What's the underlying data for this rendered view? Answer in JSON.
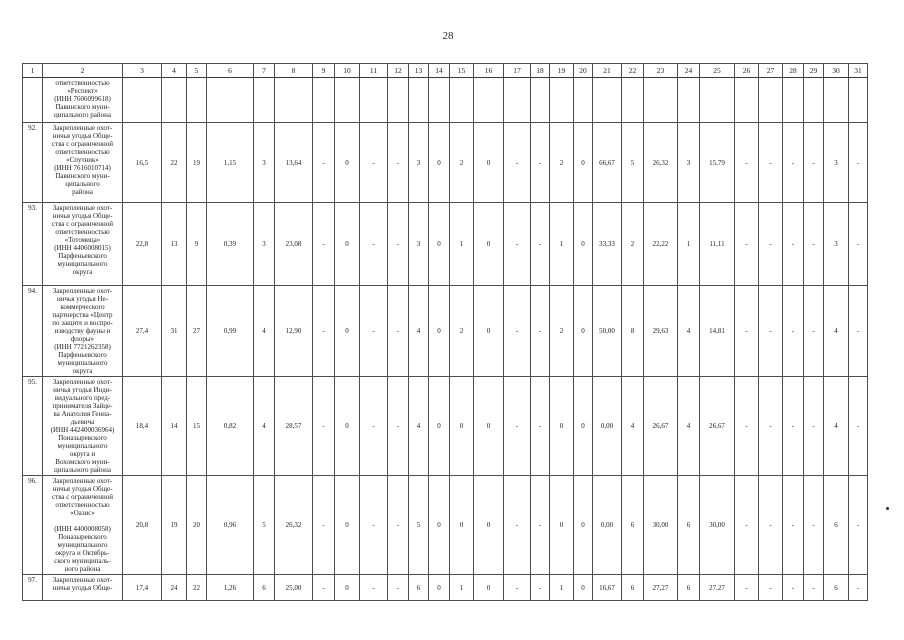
{
  "page_number": "28",
  "table": {
    "column_headers": [
      "1",
      "2",
      "3",
      "4",
      "5",
      "6",
      "7",
      "8",
      "9",
      "10",
      "11",
      "12",
      "13",
      "14",
      "15",
      "16",
      "17",
      "18",
      "19",
      "20",
      "21",
      "22",
      "23",
      "24",
      "25",
      "26",
      "27",
      "28",
      "29",
      "30",
      "31"
    ],
    "rows": [
      {
        "num": "",
        "name_lines": [
          "ответственностью",
          "«Респект»",
          "(ИНН 7606099618)",
          "Павинского муни-",
          "ципального района"
        ],
        "values": [
          "",
          "",
          "",
          "",
          "",
          "",
          "",
          "",
          "",
          "",
          "",
          "",
          "",
          "",
          "",
          "",
          "",
          "",
          "",
          "",
          "",
          "",
          "",
          "",
          "",
          "",
          "",
          "",
          ""
        ]
      },
      {
        "num": "92.",
        "name_lines": [
          "Закрепленные охот-",
          "ничья угодья Обще-",
          "ства с ограниченной",
          "ответственностью",
          "«Спутник»",
          "(ИНН 7616010714)",
          "Павинского муни-",
          "ципального",
          "района"
        ],
        "values": [
          "16,5",
          "22",
          "19",
          "1,15",
          "3",
          "13,64",
          "-",
          "0",
          "-",
          "-",
          "3",
          "0",
          "2",
          "0",
          "-",
          "-",
          "2",
          "0",
          "66,67",
          "5",
          "26,32",
          "3",
          "15,79",
          "-",
          "-",
          "-",
          "-",
          "3",
          "-"
        ]
      },
      {
        "num": "93.",
        "name_lines": [
          "Закрепленные охот-",
          "ничья угодья Обще-",
          "ства с ограниченной",
          "ответственностью",
          "«Тотомица»",
          "(ИНН 4406008015)",
          "Парфеньевского",
          "муниципального",
          "округа"
        ],
        "values": [
          "22,8",
          "13",
          "9",
          "0,39",
          "3",
          "23,08",
          "-",
          "0",
          "-",
          "-",
          "3",
          "0",
          "1",
          "0",
          "-",
          "-",
          "1",
          "0",
          "33,33",
          "2",
          "22,22",
          "1",
          "11,11",
          "-",
          "-",
          "-",
          "-",
          "3",
          "-"
        ]
      },
      {
        "num": "94.",
        "name_lines": [
          "Закрепленные охот-",
          "ничья угодья Не-",
          "коммерческого",
          "партнерства «Центр",
          "по защите и воспро-",
          "изводству фауны и",
          "флоры»",
          "(ИНН 7721262358)",
          "Парфеньевского",
          "муниципального",
          "округа"
        ],
        "values": [
          "27,4",
          "31",
          "27",
          "0,99",
          "4",
          "12,90",
          "-",
          "0",
          "-",
          "-",
          "4",
          "0",
          "2",
          "0",
          "-",
          "-",
          "2",
          "0",
          "50,00",
          "8",
          "29,63",
          "4",
          "14,81",
          "-",
          "-",
          "-",
          "-",
          "4",
          "-"
        ]
      },
      {
        "num": "95.",
        "name_lines": [
          "Закрепленные охот-",
          "ничья угодья Инди-",
          "видуального пред-",
          "принимателя Зайце-",
          "ва Анатолия Генна-",
          "дьевича",
          "(ИНН 442400036964)",
          "Поназыревского",
          "муниципального",
          "округа и",
          "Вохомского муни-",
          "ципального района"
        ],
        "values": [
          "18,4",
          "14",
          "15",
          "0,82",
          "4",
          "28,57",
          "-",
          "0",
          "-",
          "-",
          "4",
          "0",
          "0",
          "0",
          "-",
          "-",
          "0",
          "0",
          "0,00",
          "4",
          "26,67",
          "4",
          "26,67",
          "-",
          "-",
          "-",
          "-",
          "4",
          "-"
        ]
      },
      {
        "num": "96.",
        "name_lines": [
          "Закрепленные охот-",
          "ничья угодья Обще-",
          "ства с ограниченной",
          "ответственностью",
          "«Оазис»",
          "",
          "(ИНН 4400008058)",
          "Поназыревского",
          "муниципального",
          "округа и Октябрь-",
          "ского муниципаль-",
          "ного района"
        ],
        "values": [
          "20,8",
          "19",
          "20",
          "0,96",
          "5",
          "26,32",
          "-",
          "0",
          "-",
          "-",
          "5",
          "0",
          "0",
          "0",
          "-",
          "-",
          "0",
          "0",
          "0,00",
          "6",
          "30,00",
          "6",
          "30,00",
          "-",
          "-",
          "-",
          "-",
          "6",
          "-"
        ]
      },
      {
        "num": "97.",
        "name_lines": [
          "Закрепленные охот-",
          "ничья угодья Обще-"
        ],
        "values": [
          "17,4",
          "24",
          "22",
          "1,26",
          "6",
          "25,00",
          "-",
          "0",
          "-",
          "-",
          "6",
          "0",
          "1",
          "0",
          "-",
          "-",
          "1",
          "0",
          "16,67",
          "6",
          "27,27",
          "6",
          "27,27",
          "-",
          "-",
          "-",
          "-",
          "6",
          "-"
        ]
      }
    ]
  }
}
